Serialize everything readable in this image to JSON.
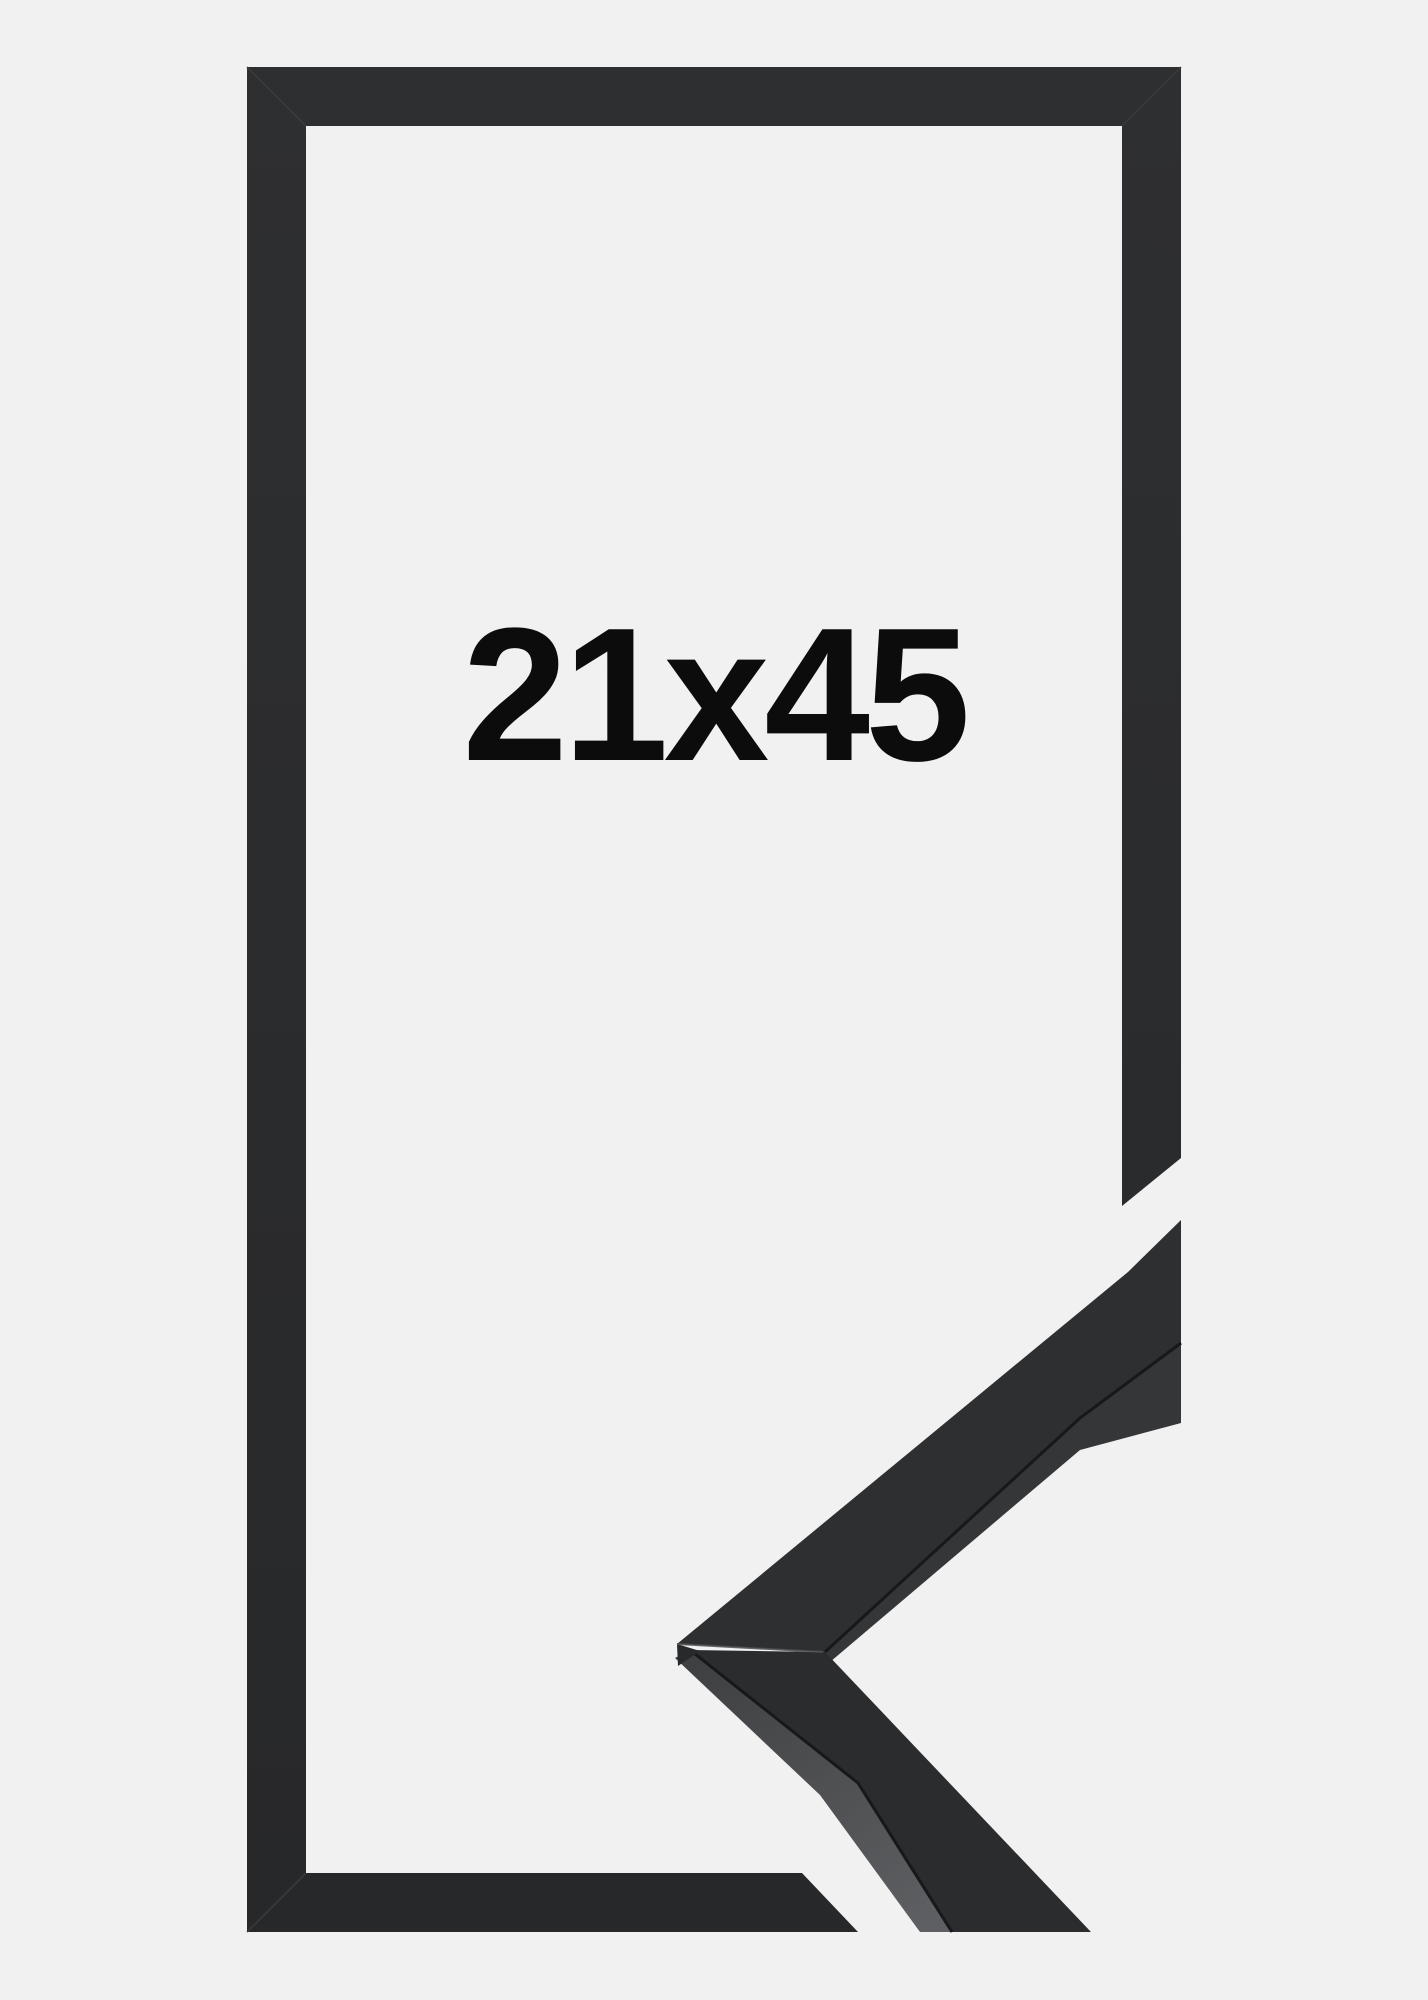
{
  "product": {
    "size_label": "21x45"
  },
  "colors": {
    "background": "#f1f1f2",
    "text": "#0c0c0c",
    "frame_shade_top": "#2e2f31",
    "frame_shade_bottom": "#27282a",
    "frame_corner_seam": "#3a3b3d",
    "profile_top": "#2e2f31",
    "profile_top_lower": "#2b2c2e",
    "profile_inner_side": "#353638",
    "profile_outer_side_top": "#3e3f41",
    "profile_outer_side_bottom": "#5e5f62",
    "profile_crease": "#17181a",
    "profile_miter_seam": "#4f5052",
    "profile_tip_facet": "#28292b"
  }
}
